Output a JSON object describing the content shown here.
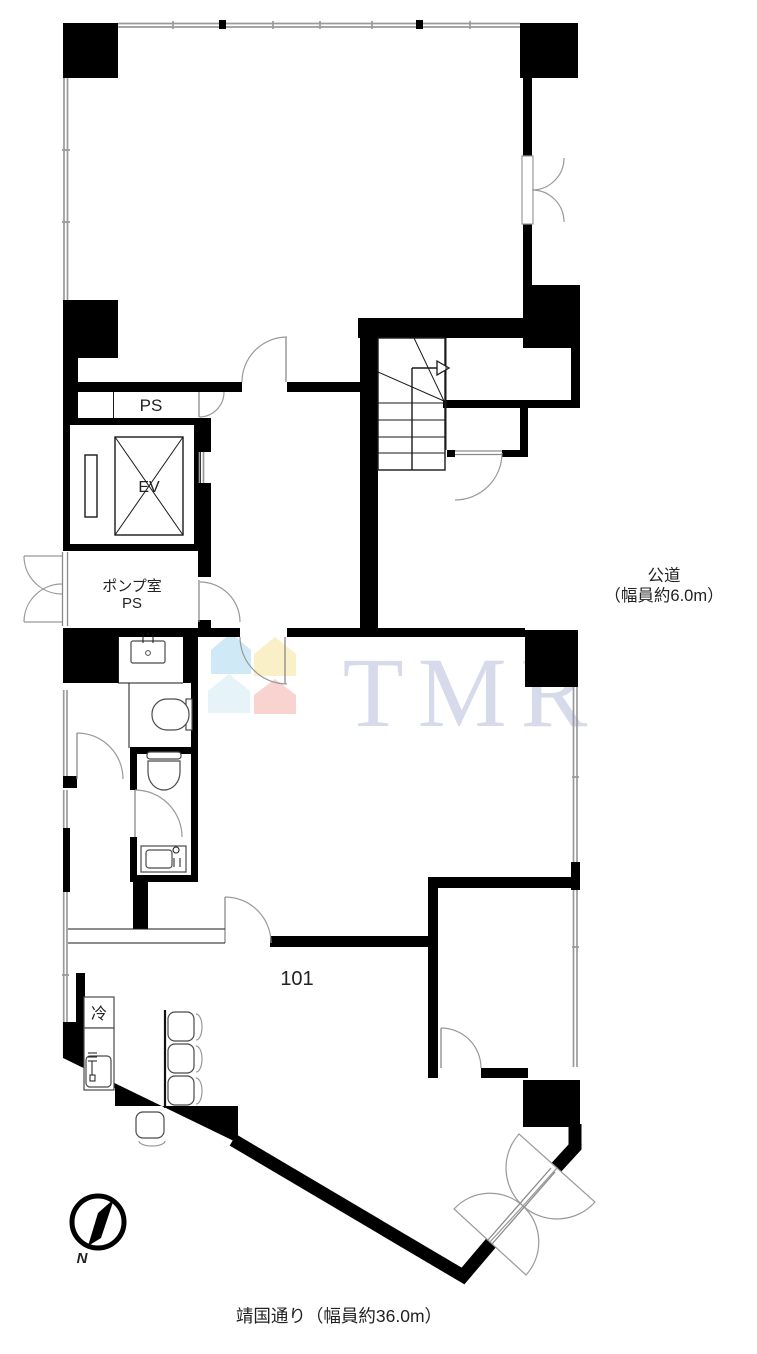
{
  "labels": {
    "ps": "PS",
    "ev": "EV",
    "pump_room": "ポンプ室",
    "pump_room_ps": "PS",
    "unit": "101",
    "fridge": "冷"
  },
  "annotations": {
    "road_line1": "公道",
    "road_line2": "（幅員約6.0m）",
    "street": "靖国通り（幅員約36.0m）",
    "north": "N"
  },
  "watermark": {
    "text": "TMR",
    "text_color": "#d6daea",
    "houses": {
      "top_left": "#cfe9f6",
      "top_right": "#f9f0c8",
      "bottom_left": "#e6f4fa",
      "bottom_right": "#f8d3d0"
    }
  },
  "colors": {
    "wall": "#000000",
    "thin_line": "#1a1a1a",
    "window_line": "#9a9a9a",
    "door_arc": "#999999",
    "background": "#ffffff"
  }
}
